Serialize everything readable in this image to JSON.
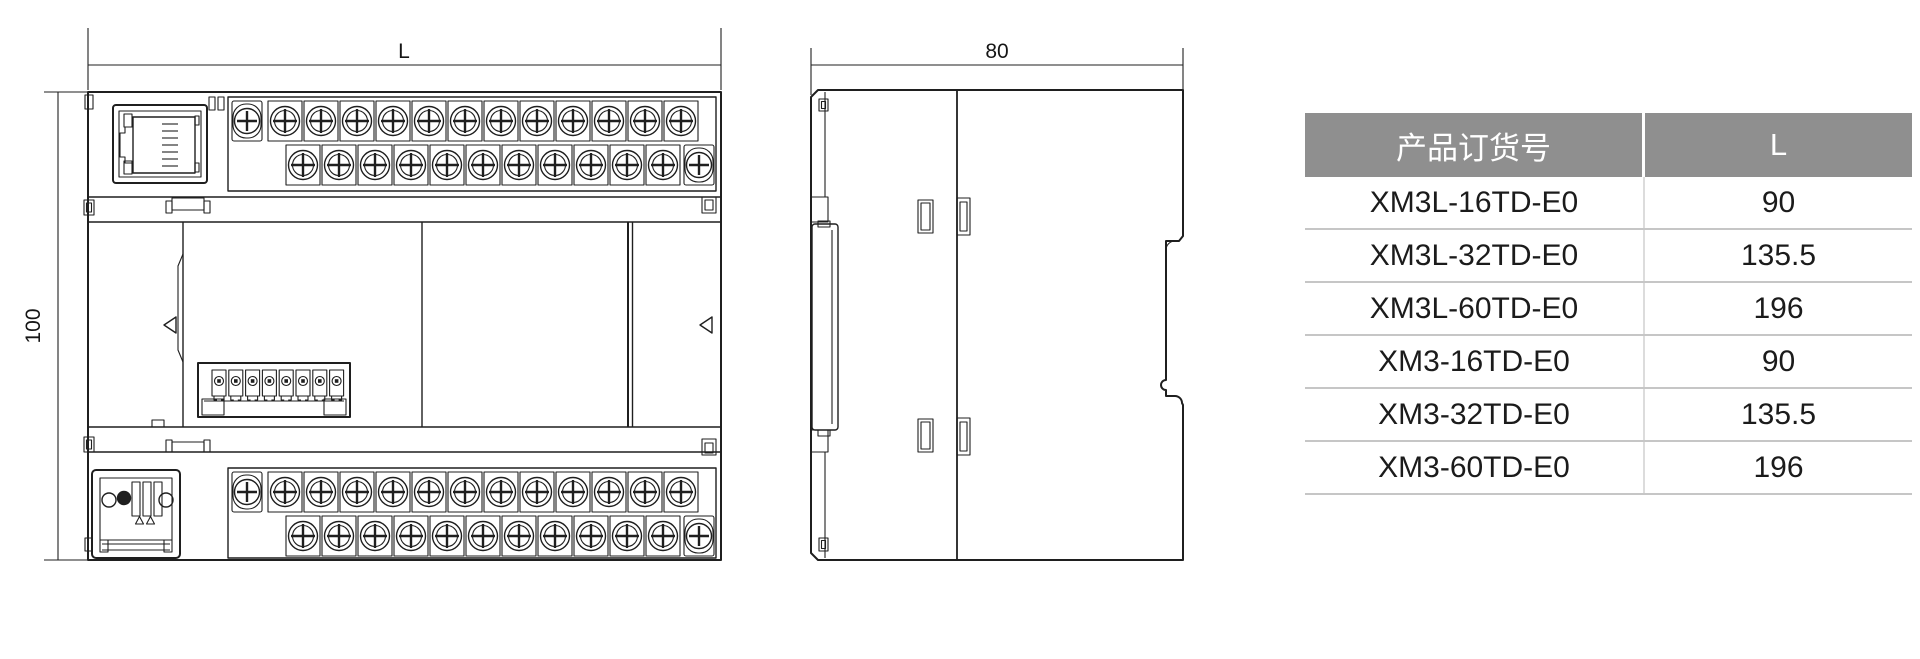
{
  "dimensions": {
    "front_width": "L",
    "front_height": "100",
    "side_width": "80"
  },
  "table": {
    "headers": [
      "产品订货号",
      "L"
    ],
    "rows": [
      [
        "XM3L-16TD-E0",
        "90"
      ],
      [
        "XM3L-32TD-E0",
        "135.5"
      ],
      [
        "XM3L-60TD-E0",
        "196"
      ],
      [
        "XM3-16TD-E0",
        "90"
      ],
      [
        "XM3-32TD-E0",
        "135.5"
      ],
      [
        "XM3-60TD-E0",
        "196"
      ]
    ]
  },
  "drawing": {
    "front_view": {
      "top_strip": {
        "row1_circled": 12,
        "row1_plain_left": 1,
        "row2_circled": 11,
        "row2_plain_right": 1
      },
      "bottom_strip": {
        "row1_circled": 12,
        "row1_plain_left": 1,
        "row2_circled": 11,
        "row2_plain_right": 1
      },
      "mini_connector_pins": 8,
      "alignment_markers": 2
    },
    "side_view": {
      "latch_slots": 2,
      "side_tabs": 2
    }
  },
  "colors": {
    "line": "#1f1f1f",
    "table_header_bg": "#8f8f8f",
    "table_header_text": "#ffffff",
    "row_divider": "#c6c6c6",
    "text": "#1b1b1b"
  }
}
